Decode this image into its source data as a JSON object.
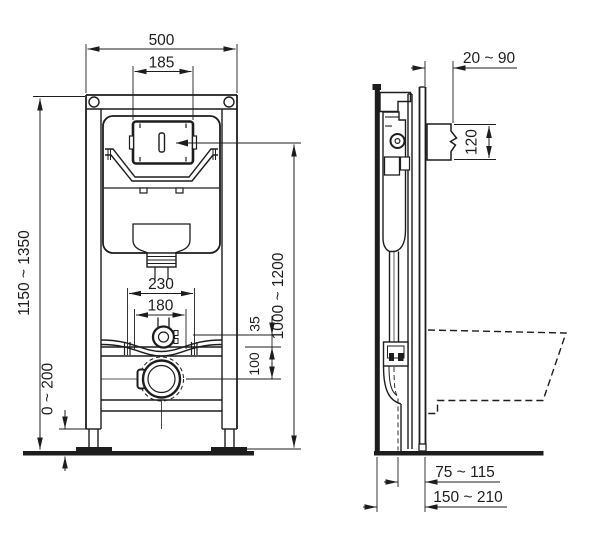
{
  "drawing": {
    "kind": "installation-frame-technical-drawing",
    "colors": {
      "line": "#1d1d1d",
      "background": "#ffffff"
    },
    "front": {
      "frame_width": "500",
      "cutout_width": "185",
      "frame_height_range": "1150 ~ 1350",
      "foot_adjustment_range": "0 ~ 200",
      "bolt_spacing_outer": "230",
      "bolt_spacing_inner": "180",
      "inlet_offset": "35",
      "outlet_offset": "100",
      "actuation_height_range": "1000 ~ 1200"
    },
    "side": {
      "wall_clearance_range": "20 ~ 90",
      "flush_bend_height": "120",
      "outlet_axis_front_range": "75 ~ 115",
      "outlet_axis_depth_range": "150 ~ 210"
    }
  }
}
